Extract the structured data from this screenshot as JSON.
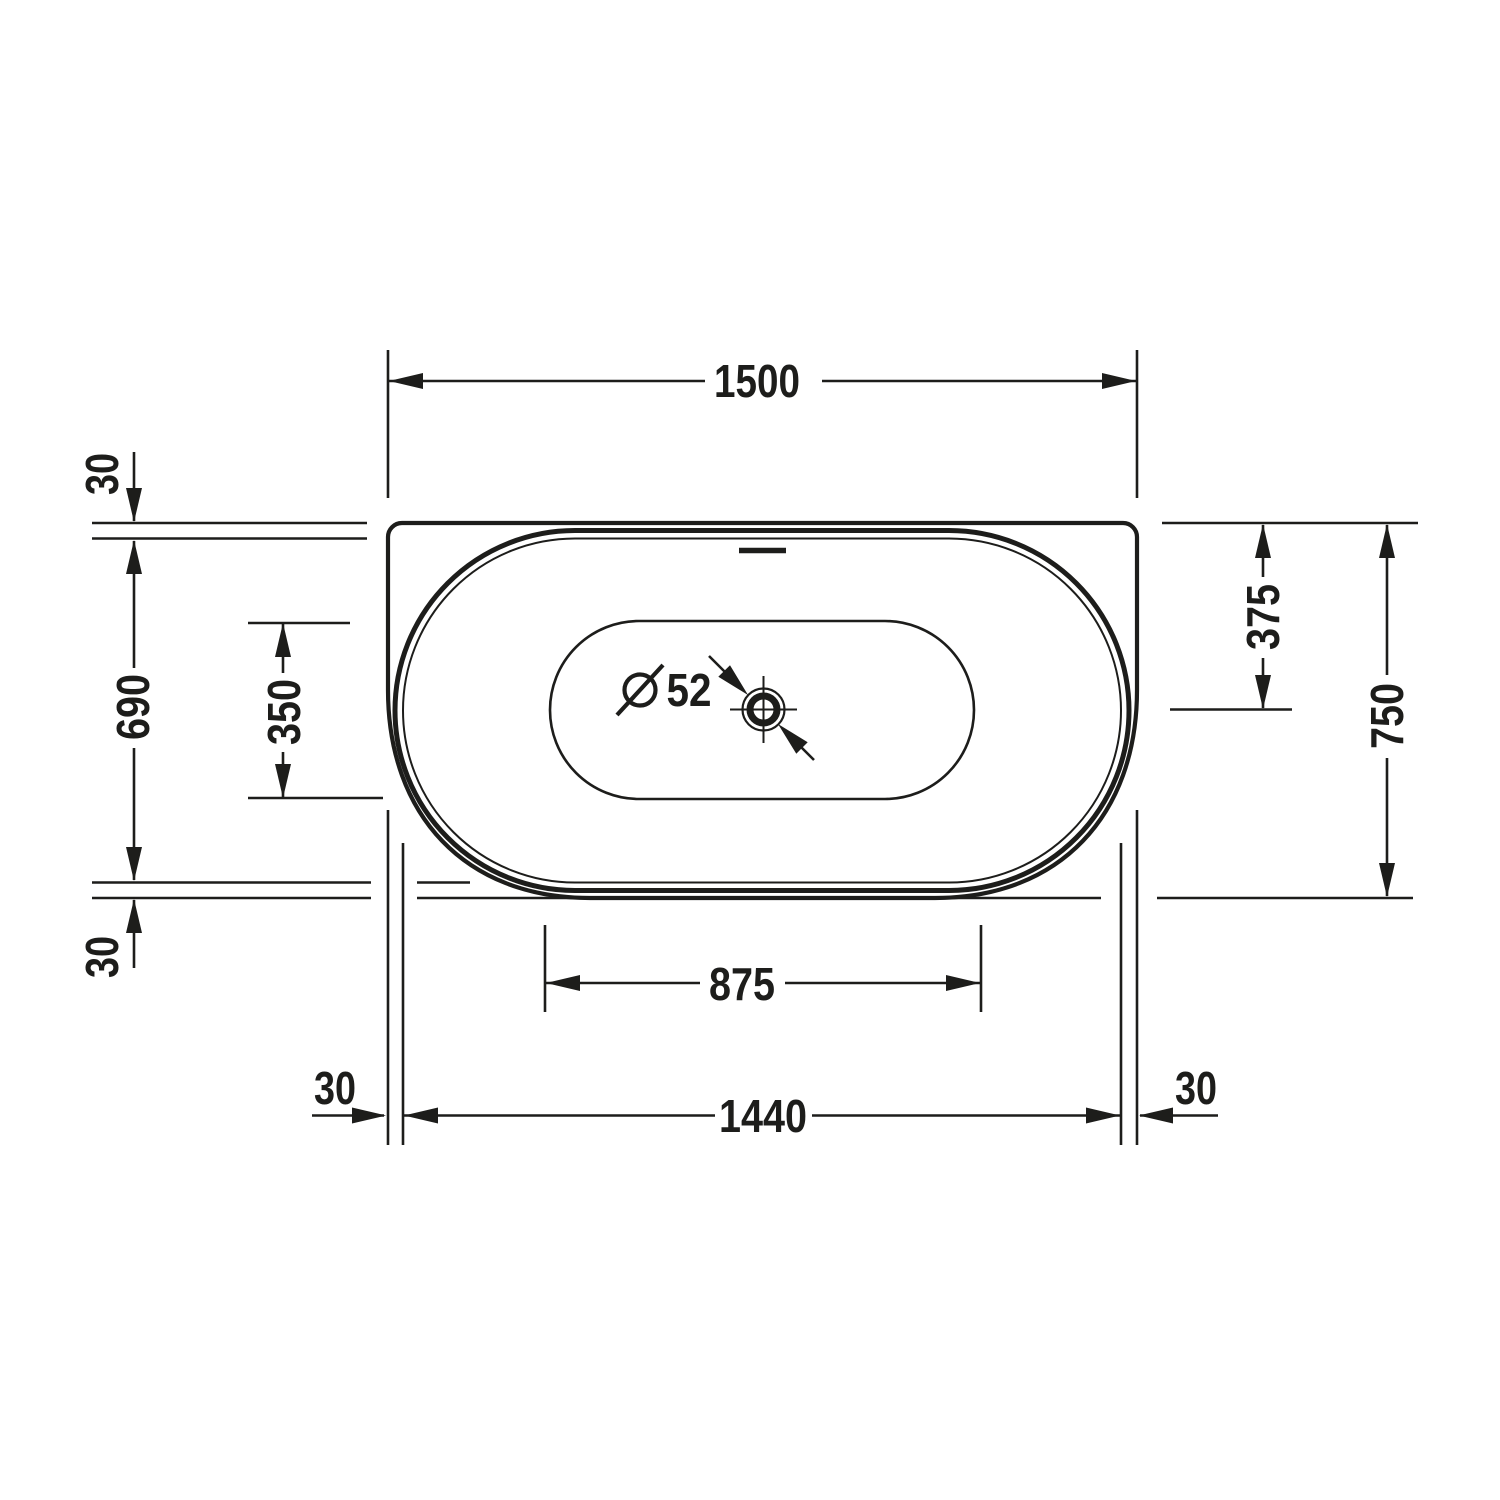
{
  "drawing": {
    "type": "technical-dimension-drawing",
    "subject": "bathtub-top-view-plan",
    "line_color": "#1d1d1b",
    "background_color": "#ffffff",
    "dimensions": {
      "overall_width": "1500",
      "overall_depth": "750",
      "rim_offset_top": "30",
      "rim_offset_bottom": "30",
      "rim_offset_left_bottom": "30",
      "rim_offset_right_bottom": "30",
      "inner_depth": "690",
      "inner_width": "1440",
      "floor_depth": "350",
      "floor_width": "875",
      "back_to_center": "375"
    },
    "drain": {
      "symbol": "diameter-sign",
      "diameter": "52"
    }
  }
}
